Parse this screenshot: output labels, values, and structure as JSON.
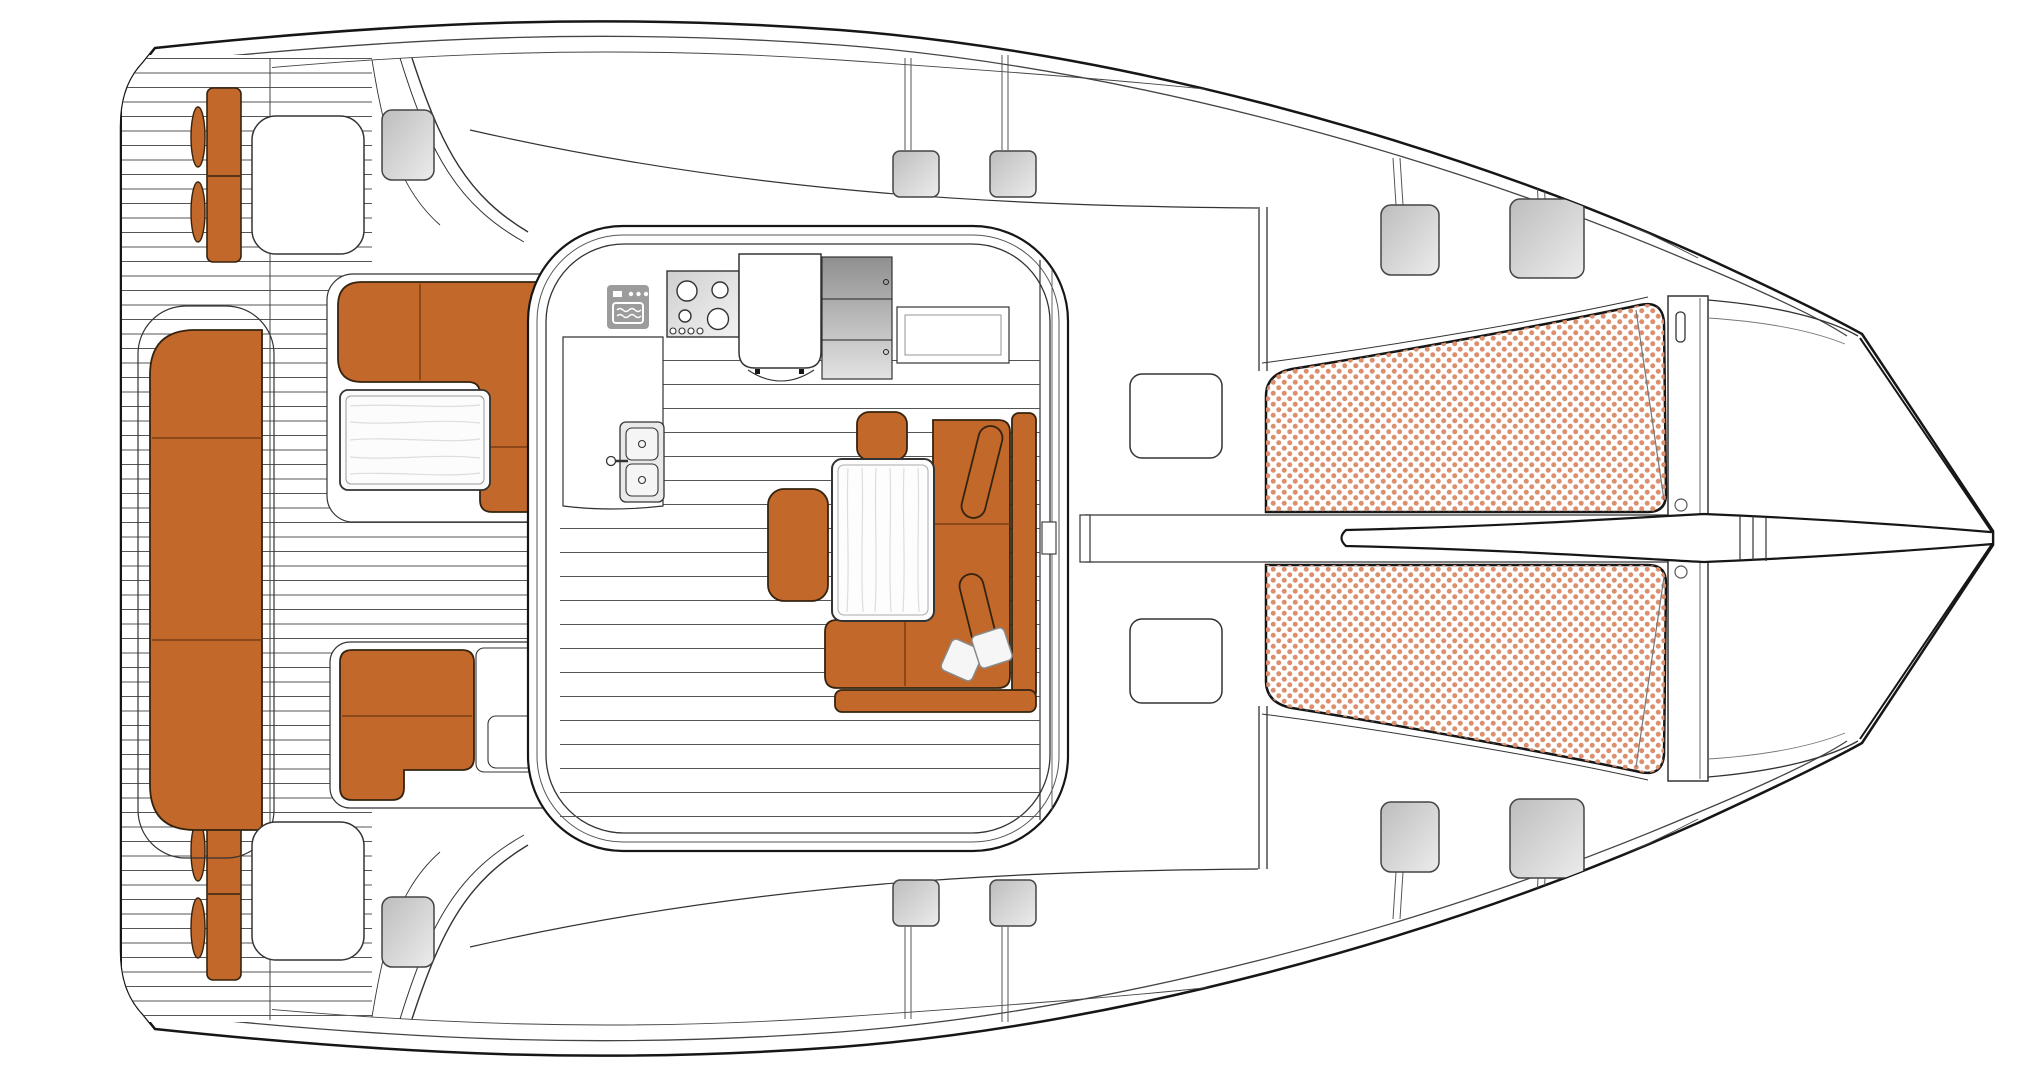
{
  "document": {
    "title": "Catamaran deck and cockpit layout plan",
    "view": "top-down floor plan",
    "orientation": "bow to the right, sterns to the left",
    "style": "technical line drawing"
  },
  "palette": {
    "background": "#ffffff",
    "outline": "#161616",
    "detail_line": "#444444",
    "teak_line": "#555555",
    "upholstery": "#C2682A",
    "upholstery_outline": "#35230f",
    "trampoline_dot": "#DB8F6D",
    "hatch_light": "#ececec",
    "hatch_dark": "#bdbdbd",
    "cabinet_light": "#e3e3e3",
    "cabinet_dark": "#8f8f8f",
    "icon_gray": "#9c9c9c",
    "wood_grain": "#dddddd",
    "pillow_white": "#f6f6f6"
  },
  "regions": {
    "stern_platforms": "transom steps with teak decking, bench cushions and fender pads",
    "aft_cockpit": "teak cockpit with L-shaped sofa, wood coffee table, bench seat and outdoor module",
    "saloon": "deckhouse with galley (oven, hob, double sink, fridge, cabinets) and dinette (wood table, stools, L-shaped sofa)",
    "foredeck": "white deck with two storage lockers and flush hatches",
    "trampolines": "twin netted trampoline panels between the hulls",
    "bow": "forward crossbeam with bowsprit and bridle lines"
  },
  "icons": [
    {
      "name": "oven-icon",
      "meaning": "built-in oven"
    },
    {
      "name": "stove-icon",
      "meaning": "four-burner hob with control knobs"
    },
    {
      "name": "sink-icon",
      "meaning": "double galley sink with faucet"
    },
    {
      "name": "snowflake-icon",
      "meaning": "refrigerator / icebox",
      "glyph": "❄"
    }
  ],
  "counts": {
    "gray_deck_hatches": 10,
    "foredeck_lockers": 2,
    "trampoline_panels": 2,
    "throw_pillows": 2,
    "sofa_bolsters": 2
  }
}
